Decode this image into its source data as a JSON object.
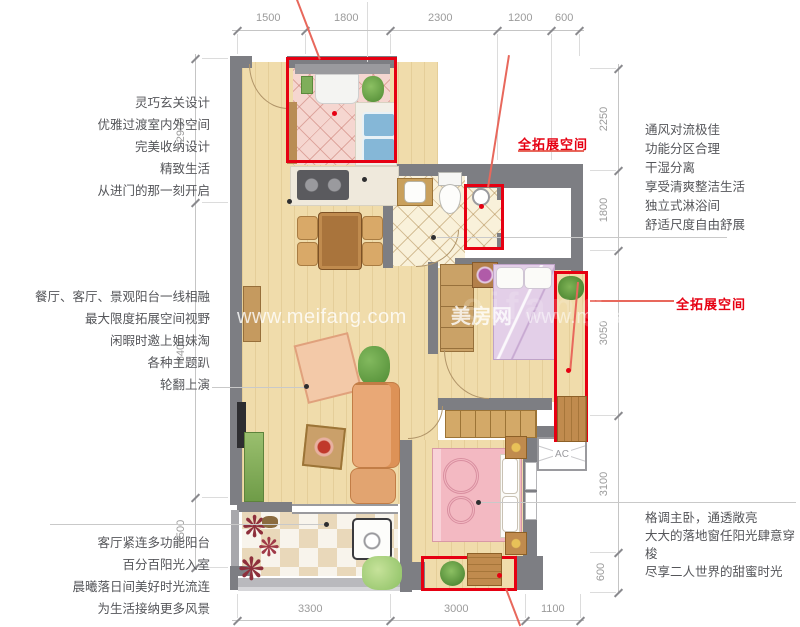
{
  "colors": {
    "accent_red": "#e60012",
    "wall_gray": "#7d7e83",
    "wood_floor": "#f0dcab",
    "dim_gray": "#9b9b9b",
    "body_text": "#55565a",
    "watermark_white": "#ffffff"
  },
  "dimensions": {
    "top": [
      "1500",
      "1800",
      "2300",
      "1200",
      "600"
    ],
    "bottom": [
      "3300",
      "3000",
      "1100"
    ],
    "left": [
      "2900",
      "6400",
      "1500"
    ],
    "right": [
      "2250",
      "1800",
      "3050",
      "3100",
      "600"
    ]
  },
  "annotations": {
    "red_labels": [
      "全拓展空间",
      "全拓展空间"
    ],
    "ac_label": "AC",
    "left_blocks": [
      {
        "lines": [
          "灵巧玄关设计",
          "优雅过渡室内外空间",
          "完美收纳设计",
          "精致生活",
          "从进门的那一刻开启"
        ]
      },
      {
        "lines": [
          "餐厅、客厅、景观阳台一线相融",
          "最大限度拓展空间视野",
          "闲暇时邀上姐妹淘",
          "各种主题趴",
          "轮翻上演"
        ]
      },
      {
        "lines": [
          "客厅紧连多功能阳台",
          "百分百阳光入室",
          "晨曦落日间美好时光流连",
          "为生活接纳更多风景"
        ]
      }
    ],
    "right_blocks": [
      {
        "lines": [
          "通风对流极佳",
          "功能分区合理",
          "干湿分离",
          "享受清爽整洁生活",
          "独立式淋浴间",
          "舒适尺度自由舒展"
        ]
      },
      {
        "lines": [
          "格调主卧，通透敞亮",
          "大大的落地窗任阳光肆意穿梭",
          "尽享二人世界的甜蜜时光"
        ]
      }
    ]
  },
  "watermark": {
    "left": "www.meifang.com",
    "brand": "美房网",
    "right": "www.meifanglo",
    "ghost": "eifang"
  }
}
